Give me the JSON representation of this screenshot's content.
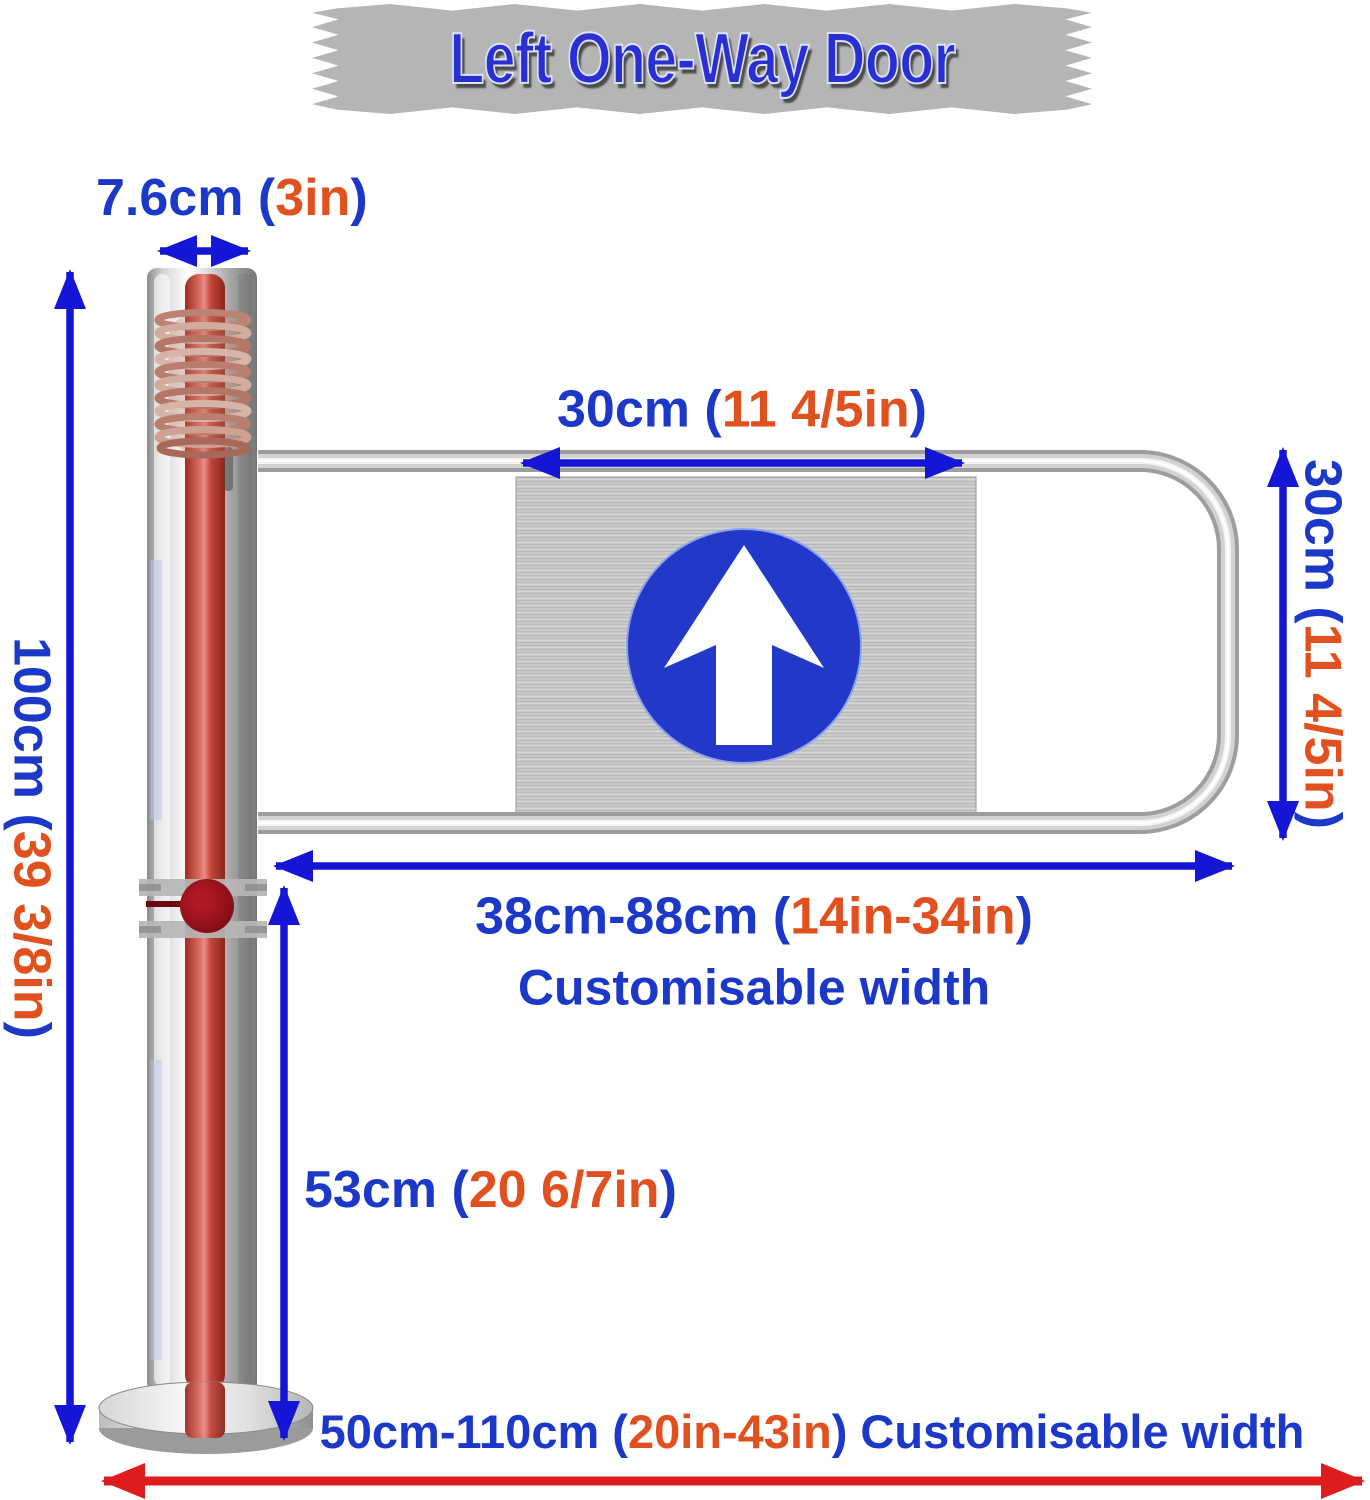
{
  "title": {
    "text": "Left One-Way Door"
  },
  "dimensions": {
    "pole_width": {
      "blue_prefix": "7.6cm (",
      "orange": "3in",
      "blue_suffix": ")"
    },
    "panel_width": {
      "blue_prefix": "30cm (",
      "orange": "11 4/5in",
      "blue_suffix": ")"
    },
    "gate_height": {
      "blue_prefix": "30cm (",
      "orange": "11 4/5in",
      "blue_suffix": ")"
    },
    "pole_height": {
      "blue_prefix": "100cm (",
      "orange": "39 3/8in",
      "blue_suffix": ")"
    },
    "gate_width": {
      "blue_prefix": "38cm-88cm (",
      "orange": "14in-34in",
      "blue_suffix": ")",
      "note": "Customisable width"
    },
    "clearance": {
      "blue_prefix": "53cm (",
      "orange": "20 6/7in",
      "blue_suffix": ")"
    },
    "total_width": {
      "blue_prefix": "50cm-110cm (",
      "orange": "20in-43in",
      "blue_suffix": ") Customisable width"
    }
  },
  "icons": {
    "direction_sign": "up-arrow"
  },
  "colors": {
    "dimension_text_blue": "#1b38c9",
    "dimension_text_orange": "#e0511f",
    "arrow_blue": "#1515d6",
    "arrow_red": "#dd1d1d",
    "title_blue": "#2a2fd4",
    "banner_gray": "#b5b5b5",
    "sign_circle_blue": "#2138c8"
  }
}
